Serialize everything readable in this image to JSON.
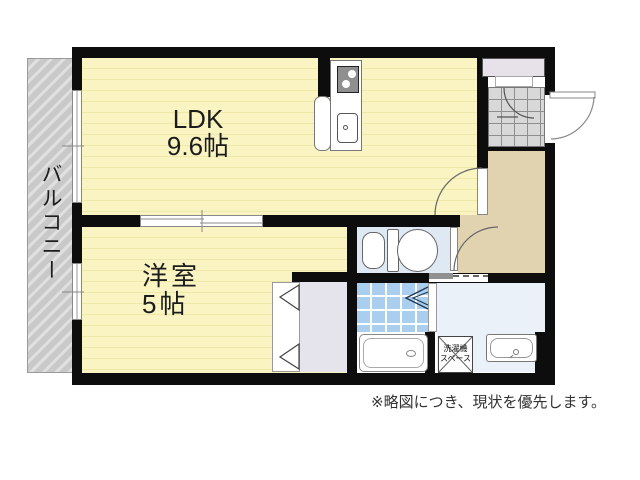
{
  "floor_plan": {
    "ldk": {
      "label": "LDK",
      "size": "9.6帖"
    },
    "western_room": {
      "label": "洋室",
      "size": "5帖"
    },
    "balcony": {
      "label": "バルコニー"
    },
    "laundry_space": {
      "line1": "洗濯機",
      "line2": "スペース"
    },
    "disclaimer": "※略図につき、現状を優先します。"
  },
  "colors": {
    "room_floor": "#f9f4c2",
    "room_floor_stripe": "#efe8a9",
    "hallway": "#e1d3b0",
    "toilet_room": "#dfe9f4",
    "washroom": "#eaf1f8",
    "bath_tile": "#a9ceee",
    "closet": "#e5e4ec",
    "entrance_tile": "#d8d8d8",
    "shoe_cabinet": "#e7e1ea",
    "balcony_hatch": "#c9c9c9",
    "wall": "#0d0d0d"
  }
}
